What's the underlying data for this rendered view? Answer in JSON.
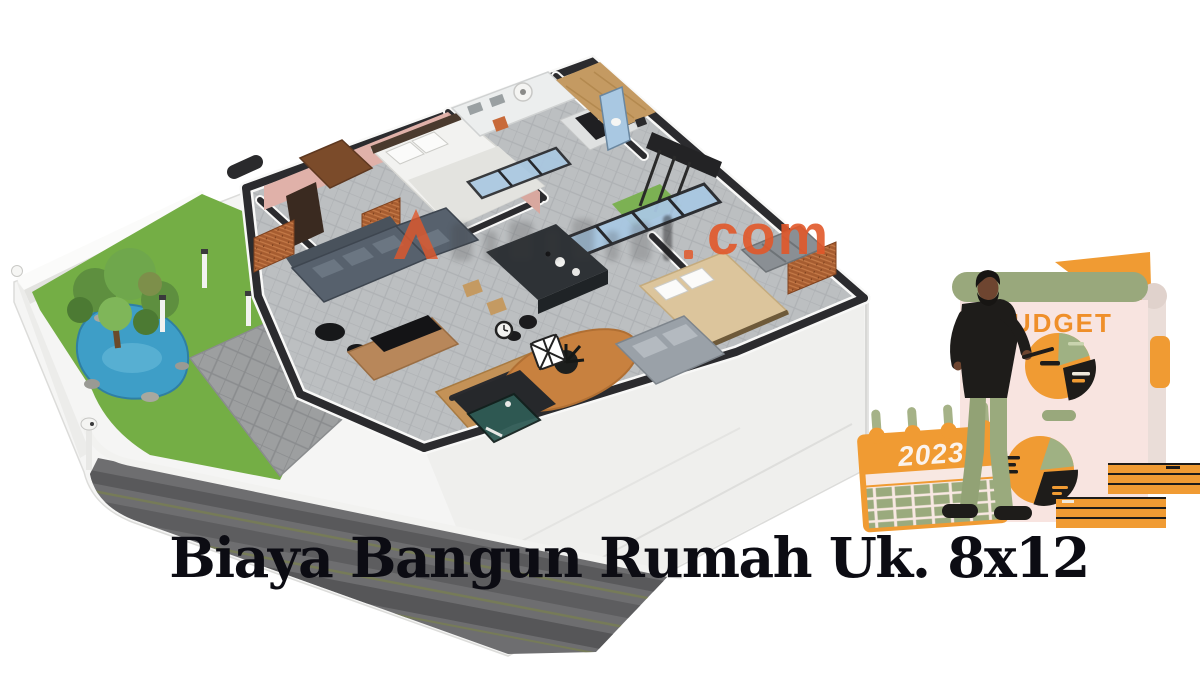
{
  "page": {
    "width": 1200,
    "height": 675,
    "background": "#ffffff",
    "kind": "article hero image"
  },
  "title": {
    "text": "Biaya Bangun Rumah Uk. 8x12",
    "color": "#0c0c13"
  },
  "watermark": {
    "suffix": "com",
    "accent_color": "#e2582a"
  },
  "budget": {
    "title": "BUDGET",
    "year": "2023",
    "colors": {
      "orange": "#F09B33",
      "sage_green": "#99A87C",
      "page_pink": "#F8E4E0",
      "ink_black": "#1E1C1A",
      "budget_text": "#EF8F2A",
      "label_cream": "#EFE9DC",
      "label_green": "#C9D4AE"
    }
  },
  "floorplan": {
    "subject": "isometric 3D house floor plan render",
    "colors": {
      "lawn_green": "#74AE45",
      "pond_blue": "#3E9EC7",
      "driveway_gray": "#6E6E70",
      "tile_gray": "#BCBFC1",
      "wall_charcoal": "#2B2B2E",
      "brick_orange": "#A65C30",
      "bedroom_pink": "#E0B1A9",
      "wood_tan": "#C49A62",
      "glass_blue": "#A9C8E2",
      "sofa_slate": "#57616D",
      "platform_white": "#F5F5F4"
    }
  }
}
